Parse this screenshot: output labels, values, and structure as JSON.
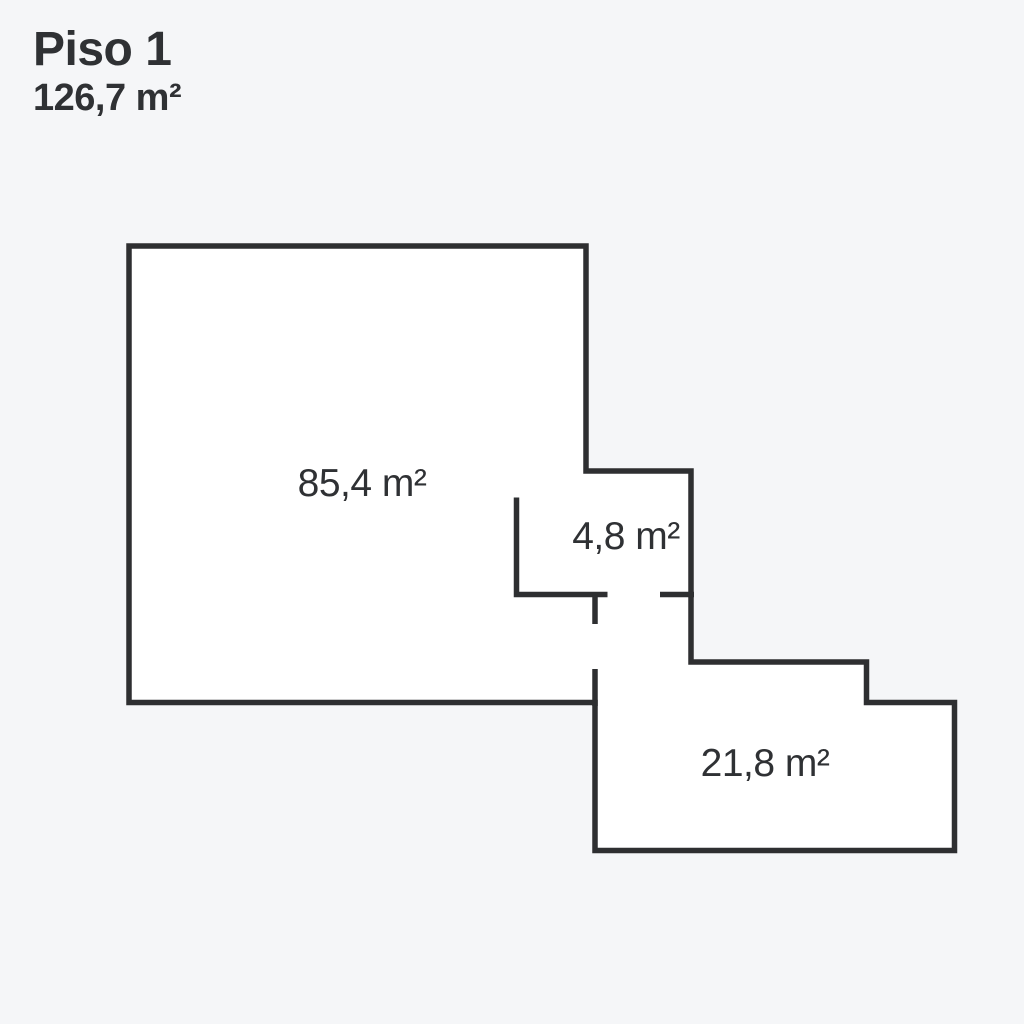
{
  "page": {
    "background_color": "#f5f6f8"
  },
  "header": {
    "title": "Piso 1",
    "subtitle": "126,7 m²"
  },
  "floorplan": {
    "wall_color": "#2e2f31",
    "room_fill_color": "#ffffff",
    "label_color": "#2f3134",
    "rooms": [
      {
        "label": "85,4 m²"
      },
      {
        "label": "4,8 m²"
      },
      {
        "label": "21,8 m²"
      }
    ]
  }
}
